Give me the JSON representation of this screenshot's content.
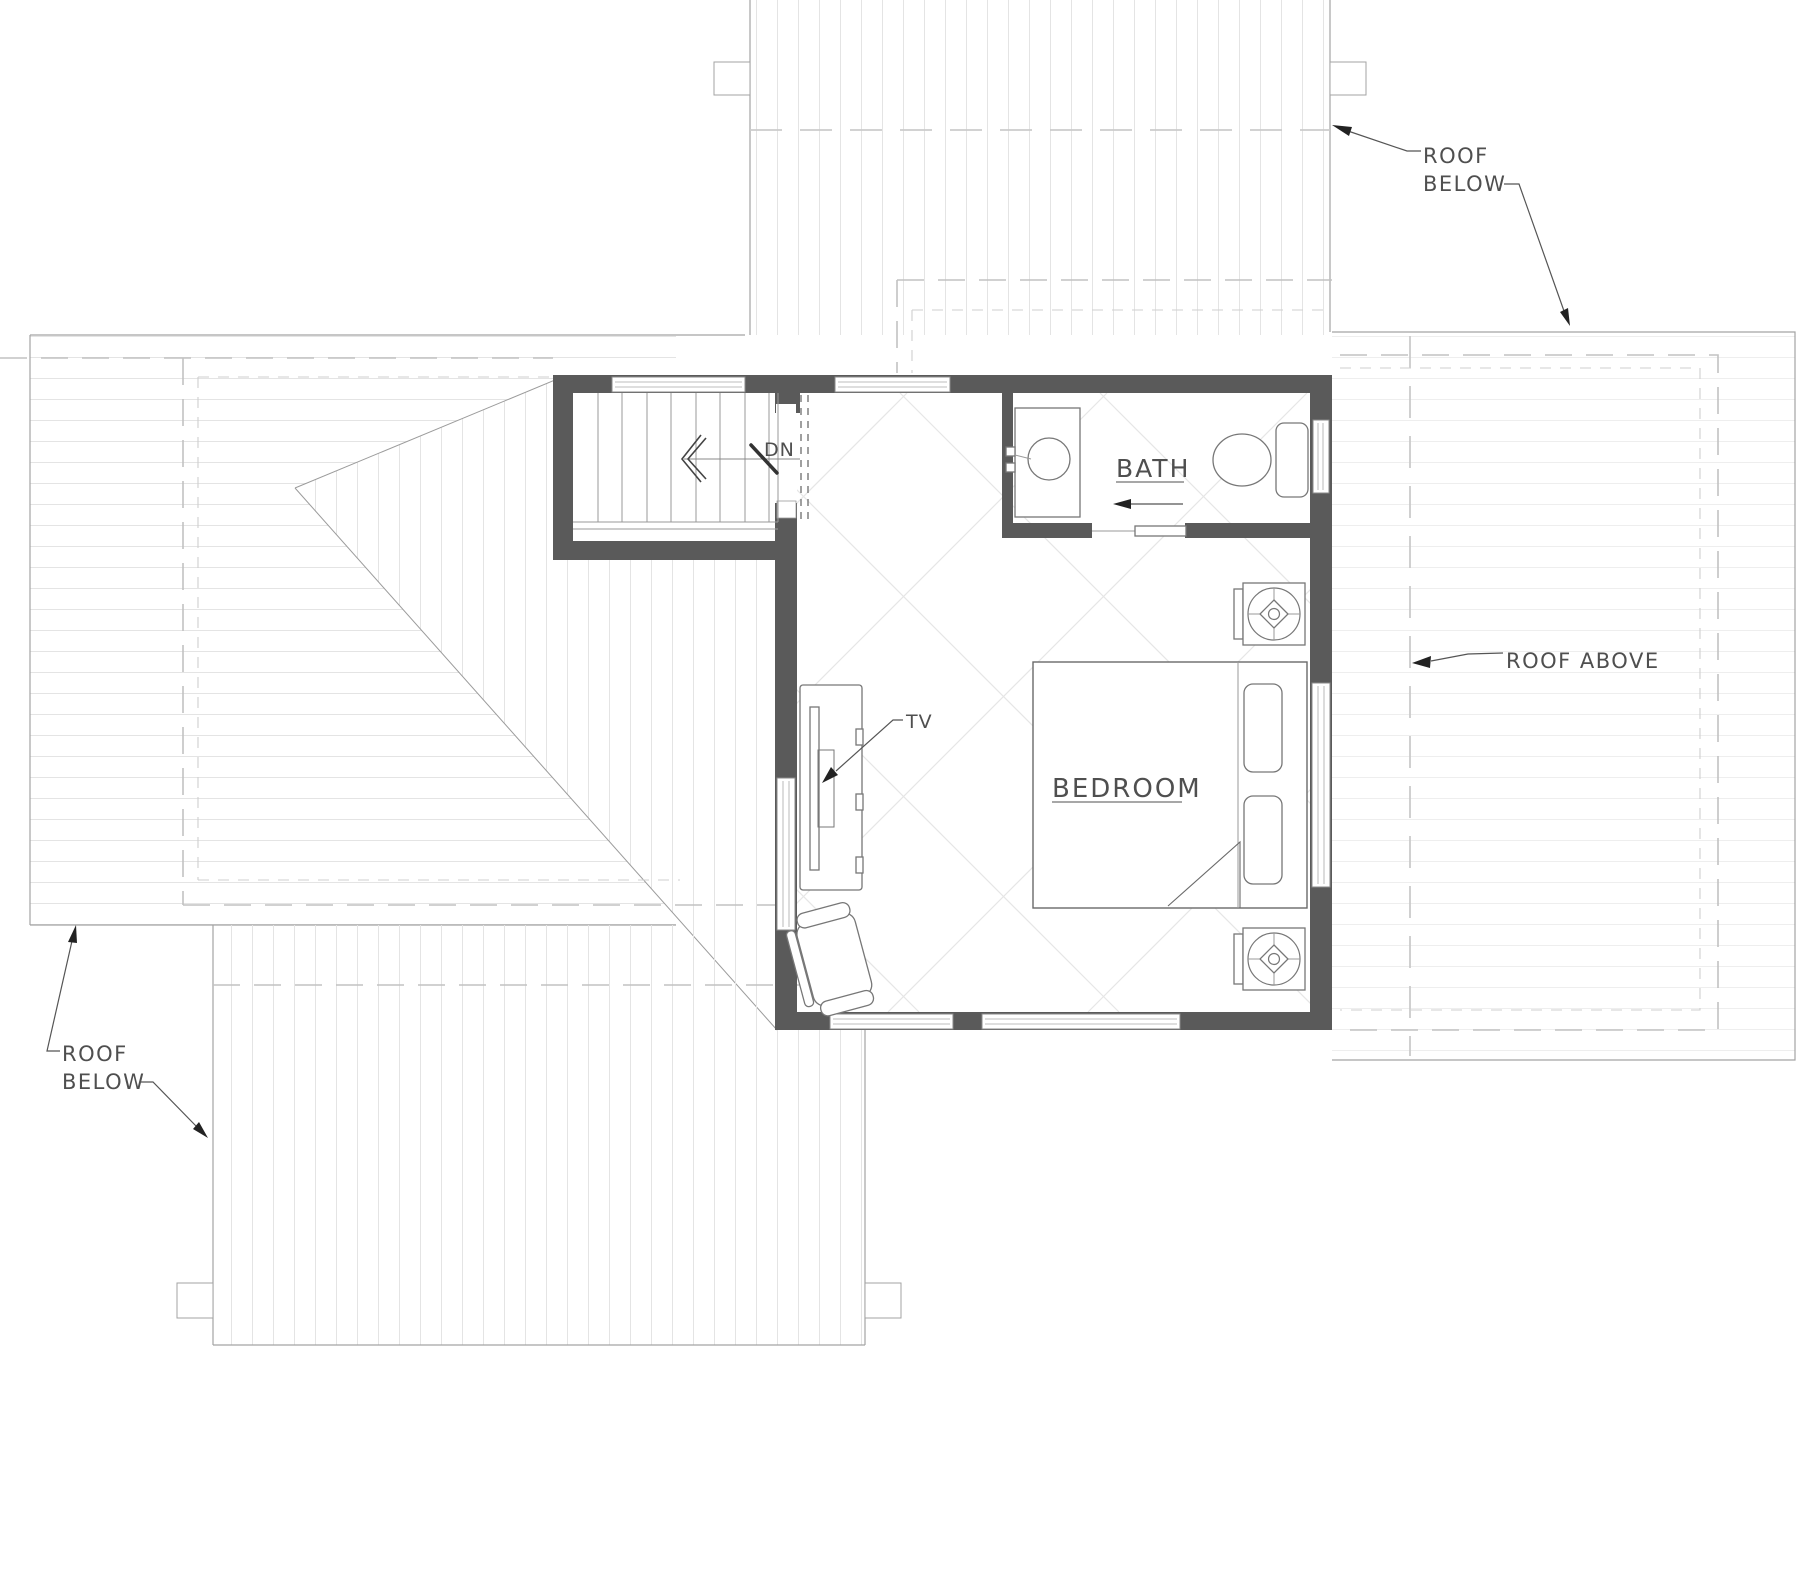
{
  "drawing": {
    "type": "floor-plan",
    "floor": "upper floor plan with roof planes"
  },
  "labels": {
    "roof_below_top": {
      "line1": "ROOF",
      "line2": "BELOW"
    },
    "roof_below_bottom": {
      "line1": "ROOF",
      "line2": "BELOW"
    },
    "roof_above": "ROOF ABOVE",
    "bath": "BATH",
    "bedroom": "BEDROOM",
    "down": "DN",
    "tv": "TV"
  },
  "colors": {
    "wall": "#5a5a5a",
    "roofline": "#a3a3a3",
    "stripe": "#e4e4e4",
    "stripe_faint": "#eeeeee",
    "dash": "#c2c2c2",
    "hatch": "#e2e2e2",
    "text": "#4f4f4f"
  }
}
